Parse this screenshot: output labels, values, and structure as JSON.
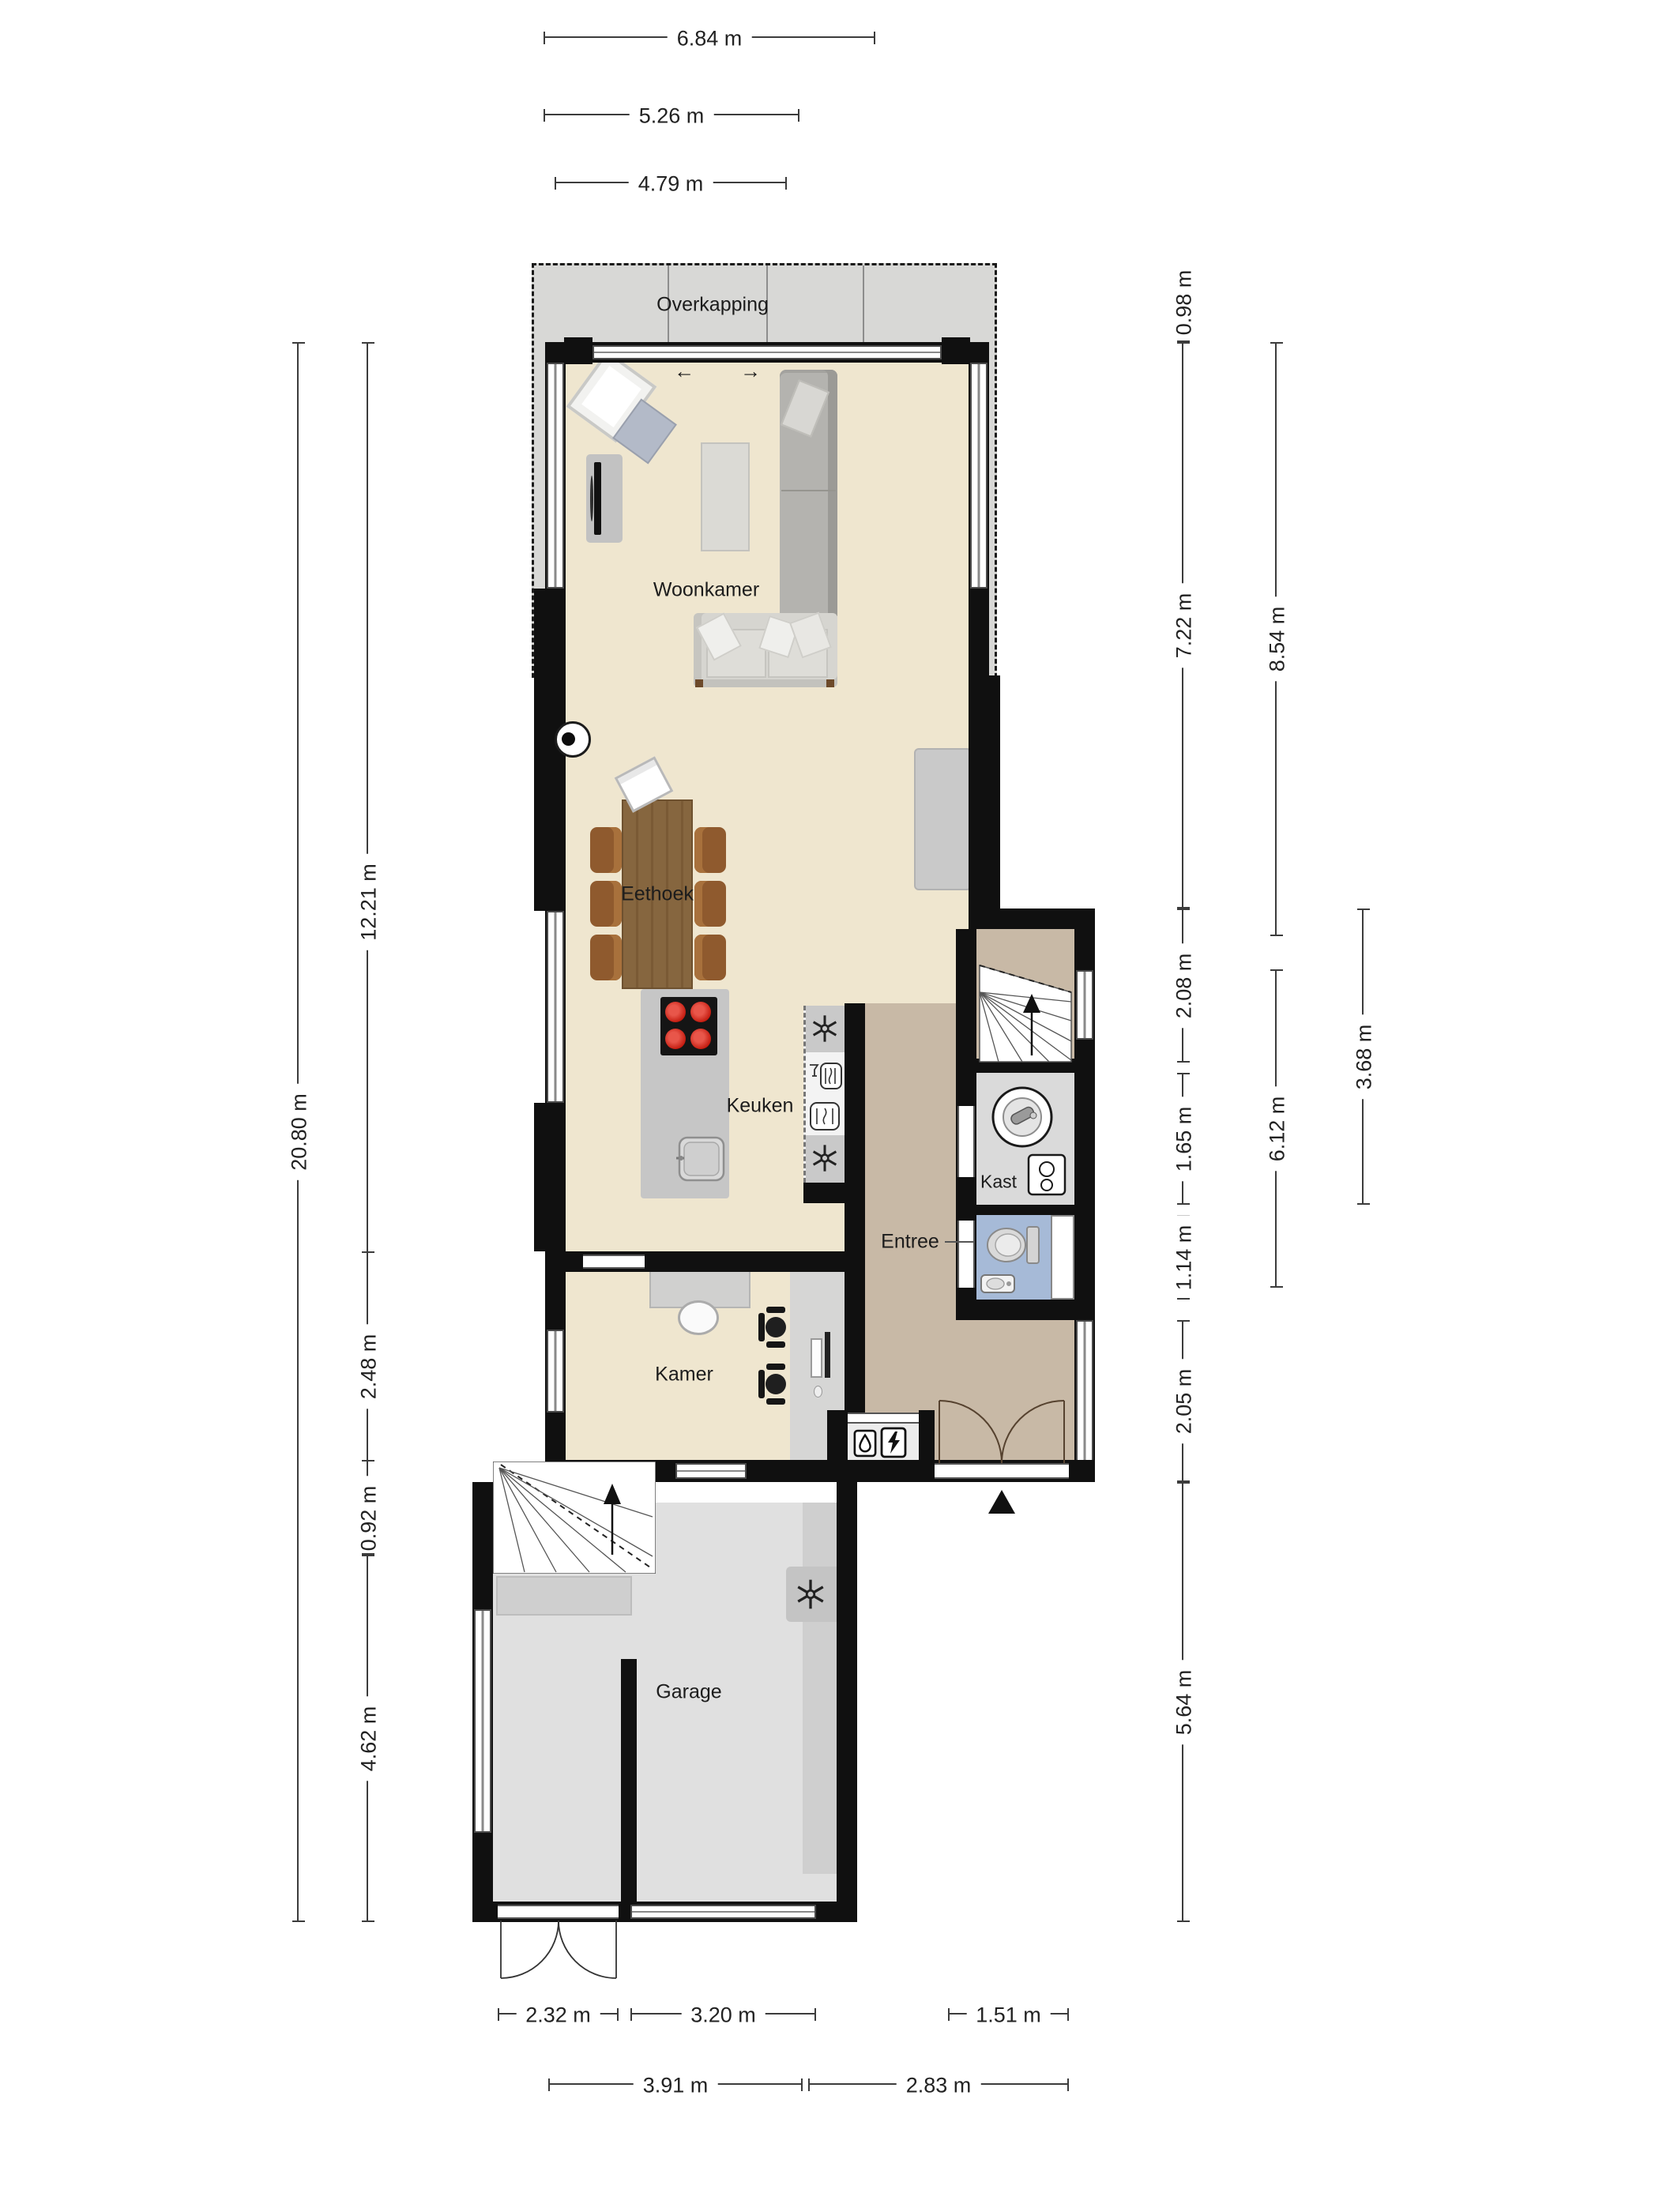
{
  "app": {
    "type": "floorplan-ground-floor"
  },
  "colors": {
    "wall": "#101010",
    "dim": "#3c3c3c",
    "floor_main": "#efe6cf",
    "floor_entree": "#c8b9a6",
    "floor_kast": "#dadada",
    "floor_wc": "#a6bad7",
    "floor_garage": "#e0e0e0",
    "floor_overkapping": "#d8d8d6",
    "counter": "#cfcfcf",
    "island": "#c6c6c6",
    "wood": "#86663f",
    "chair": "#8f5a2e",
    "burner": "#c1170b",
    "burner_hi": "#e8564a",
    "door_arc": "#56422f"
  },
  "rooms": {
    "overkapping": "Overkapping",
    "woonkamer": "Woonkamer",
    "eethoek": "Eethoek",
    "keuken": "Keuken",
    "kast": "Kast",
    "entree": "Entree",
    "kamer": "Kamer",
    "garage": "Garage"
  },
  "dims": {
    "top": [
      "6.84 m",
      "5.26 m",
      "4.79 m"
    ],
    "left": [
      "20.80 m",
      "12.21 m",
      "2.48 m",
      "0.92 m",
      "4.62 m"
    ],
    "right": [
      "0.98 m",
      "7.22 m",
      "2.08 m",
      "1.65 m",
      "1.14 m",
      "2.05 m",
      "5.64 m",
      "8.54 m",
      "6.12 m",
      "3.68 m"
    ],
    "bottom": [
      "2.32 m",
      "3.20 m",
      "1.51 m",
      "3.91 m",
      "2.83 m"
    ]
  },
  "icons": {
    "slide_left": "←",
    "slide_right": "→"
  }
}
